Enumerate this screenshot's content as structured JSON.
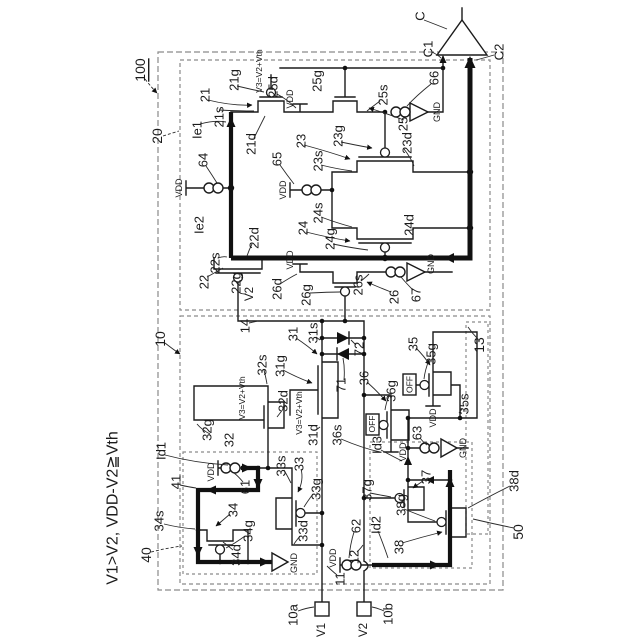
{
  "colors": {
    "ink": "#1b1b1b",
    "dashed_box": "#8a8a8a",
    "background": "#ffffff"
  },
  "figure_condition": "V1>V2, VDD-V2≧Vth",
  "labels": [
    {
      "n": "condition",
      "t": "V1>V2, VDD-V2≧Vth",
      "x": 113,
      "y": 508,
      "s": 16
    },
    {
      "n": "ref-100",
      "t": "100",
      "x": 140,
      "y": 70,
      "s": 14,
      "u": true
    },
    {
      "n": "ref-20",
      "t": "20",
      "x": 157,
      "y": 136,
      "s": 14
    },
    {
      "n": "ref-10",
      "t": "10",
      "x": 160,
      "y": 339,
      "s": 14
    },
    {
      "n": "ref-40",
      "t": "40",
      "x": 146,
      "y": 555,
      "s": 14
    },
    {
      "n": "ref-50",
      "t": "50",
      "x": 518,
      "y": 532,
      "s": 14
    },
    {
      "n": "ref-13",
      "t": "13",
      "x": 479,
      "y": 345,
      "s": 14
    },
    {
      "n": "ref-C",
      "t": "C",
      "x": 420,
      "y": 16,
      "s": 13
    },
    {
      "n": "ref-C1",
      "t": "C1",
      "x": 428,
      "y": 49,
      "s": 13
    },
    {
      "n": "ref-C2",
      "t": "C2",
      "x": 499,
      "y": 52,
      "s": 13
    },
    {
      "n": "ref-66",
      "t": "66",
      "x": 434,
      "y": 78,
      "s": 13
    },
    {
      "n": "gnd-66",
      "t": "GND",
      "x": 437,
      "y": 112,
      "s": 9
    },
    {
      "n": "ref-25",
      "t": "25",
      "x": 403,
      "y": 124,
      "s": 13
    },
    {
      "n": "ref-25s",
      "t": "25s",
      "x": 383,
      "y": 95,
      "s": 13
    },
    {
      "n": "ref-25g",
      "t": "25g",
      "x": 317,
      "y": 81,
      "s": 13
    },
    {
      "n": "ref-25d",
      "t": "25d",
      "x": 273,
      "y": 87,
      "s": 13
    },
    {
      "n": "vdd-25",
      "t": "VDD",
      "x": 290,
      "y": 99,
      "s": 9
    },
    {
      "n": "v3-21",
      "t": "V3=V2+Vth",
      "x": 259,
      "y": 71,
      "s": 8.5
    },
    {
      "n": "ref-21g",
      "t": "21g",
      "x": 234,
      "y": 80,
      "s": 13
    },
    {
      "n": "ref-21",
      "t": "21",
      "x": 205,
      "y": 95,
      "s": 13
    },
    {
      "n": "ref-21s",
      "t": "21s",
      "x": 219,
      "y": 117,
      "s": 13
    },
    {
      "n": "ref-Ie1",
      "t": "Ie1",
      "x": 197,
      "y": 130,
      "s": 13
    },
    {
      "n": "ref-21d",
      "t": "21d",
      "x": 251,
      "y": 144,
      "s": 13
    },
    {
      "n": "ref-64",
      "t": "64",
      "x": 203,
      "y": 160,
      "s": 13
    },
    {
      "n": "vdd-64",
      "t": "VDD",
      "x": 179,
      "y": 188,
      "s": 9
    },
    {
      "n": "ref-Ie2",
      "t": "Ie2",
      "x": 199,
      "y": 225,
      "s": 13
    },
    {
      "n": "ref-65",
      "t": "65",
      "x": 277,
      "y": 159,
      "s": 13
    },
    {
      "n": "vdd-65",
      "t": "VDD",
      "x": 283,
      "y": 190,
      "s": 9
    },
    {
      "n": "ref-23",
      "t": "23",
      "x": 301,
      "y": 141,
      "s": 13
    },
    {
      "n": "ref-23s",
      "t": "23s",
      "x": 318,
      "y": 161,
      "s": 13
    },
    {
      "n": "ref-23g",
      "t": "23g",
      "x": 338,
      "y": 136,
      "s": 13
    },
    {
      "n": "ref-23d",
      "t": "23d",
      "x": 407,
      "y": 143,
      "s": 13
    },
    {
      "n": "ref-24s",
      "t": "24s",
      "x": 318,
      "y": 213,
      "s": 13
    },
    {
      "n": "ref-24",
      "t": "24",
      "x": 303,
      "y": 228,
      "s": 13
    },
    {
      "n": "ref-24g",
      "t": "24g",
      "x": 330,
      "y": 239,
      "s": 13
    },
    {
      "n": "ref-24d",
      "t": "24d",
      "x": 409,
      "y": 225,
      "s": 13
    },
    {
      "n": "ref-22d",
      "t": "22d",
      "x": 254,
      "y": 238,
      "s": 13
    },
    {
      "n": "ref-22s",
      "t": "22s",
      "x": 215,
      "y": 263,
      "s": 13
    },
    {
      "n": "ref-22",
      "t": "22",
      "x": 204,
      "y": 282,
      "s": 13
    },
    {
      "n": "ref-22g",
      "t": "22g",
      "x": 236,
      "y": 283,
      "s": 13
    },
    {
      "n": "net-V2",
      "t": "V2",
      "x": 250,
      "y": 294,
      "s": 11.5
    },
    {
      "n": "ref-26d",
      "t": "26d",
      "x": 277,
      "y": 289,
      "s": 13
    },
    {
      "n": "vdd-26",
      "t": "VDD",
      "x": 290,
      "y": 260,
      "s": 9
    },
    {
      "n": "ref-26g",
      "t": "26g",
      "x": 306,
      "y": 295,
      "s": 13
    },
    {
      "n": "ref-26s",
      "t": "26s",
      "x": 358,
      "y": 285,
      "s": 13
    },
    {
      "n": "ref-26",
      "t": "26",
      "x": 394,
      "y": 297,
      "s": 13
    },
    {
      "n": "ref-67",
      "t": "67",
      "x": 416,
      "y": 295,
      "s": 13
    },
    {
      "n": "gnd-67",
      "t": "GND",
      "x": 431,
      "y": 264,
      "s": 9
    },
    {
      "n": "ref-14",
      "t": "14",
      "x": 245,
      "y": 326,
      "s": 13
    },
    {
      "n": "ref-31",
      "t": "31",
      "x": 293,
      "y": 334,
      "s": 13
    },
    {
      "n": "ref-31s",
      "t": "31s",
      "x": 313,
      "y": 333,
      "s": 13
    },
    {
      "n": "ref-31g",
      "t": "31g",
      "x": 280,
      "y": 366,
      "s": 13
    },
    {
      "n": "ref-32s",
      "t": "32s",
      "x": 262,
      "y": 365,
      "s": 13
    },
    {
      "n": "v3-32",
      "t": "V3=V2+Vth",
      "x": 242,
      "y": 398,
      "s": 8.5
    },
    {
      "n": "ref-32d",
      "t": "32d",
      "x": 283,
      "y": 401,
      "s": 13
    },
    {
      "n": "ref-32g",
      "t": "32g",
      "x": 207,
      "y": 430,
      "s": 13
    },
    {
      "n": "ref-32",
      "t": "32",
      "x": 229,
      "y": 440,
      "s": 13
    },
    {
      "n": "v3-31",
      "t": "V3=V2+Vth",
      "x": 299,
      "y": 413,
      "s": 8.5
    },
    {
      "n": "ref-31d",
      "t": "31d",
      "x": 313,
      "y": 435,
      "s": 13
    },
    {
      "n": "ref-71",
      "t": "71",
      "x": 341,
      "y": 385,
      "s": 13
    },
    {
      "n": "ref-72",
      "t": "72",
      "x": 359,
      "y": 349,
      "s": 13
    },
    {
      "n": "ref-36",
      "t": "36",
      "x": 364,
      "y": 378,
      "s": 13
    },
    {
      "n": "ref-36g",
      "t": "36g",
      "x": 391,
      "y": 391,
      "s": 13
    },
    {
      "n": "state-off-36",
      "t": "OFF",
      "x": 372,
      "y": 424,
      "s": 8.5
    },
    {
      "n": "vdd-36",
      "t": "VDD",
      "x": 403,
      "y": 452,
      "s": 9
    },
    {
      "n": "ref-36s",
      "t": "36s",
      "x": 337,
      "y": 435,
      "s": 13
    },
    {
      "n": "ref-35",
      "t": "35",
      "x": 413,
      "y": 344,
      "s": 13
    },
    {
      "n": "ref-35g",
      "t": "35g",
      "x": 431,
      "y": 354,
      "s": 13
    },
    {
      "n": "state-off-35",
      "t": "OFF",
      "x": 409.5,
      "y": 384.5,
      "s": 8.5
    },
    {
      "n": "vdd-35",
      "t": "VDD",
      "x": 433,
      "y": 418,
      "s": 9
    },
    {
      "n": "ref-35s",
      "t": "35s",
      "x": 464,
      "y": 404,
      "s": 13
    },
    {
      "n": "ref-63",
      "t": "63",
      "x": 417,
      "y": 433,
      "s": 13
    },
    {
      "n": "gnd-63",
      "t": "GND",
      "x": 463,
      "y": 448,
      "s": 9
    },
    {
      "n": "ref-Id3",
      "t": "Id3",
      "x": 377,
      "y": 445,
      "s": 13
    },
    {
      "n": "ref-37g",
      "t": "37g",
      "x": 367,
      "y": 490,
      "s": 13
    },
    {
      "n": "ref-37",
      "t": "37",
      "x": 426,
      "y": 477,
      "s": 13
    },
    {
      "n": "ref-38g",
      "t": "38g",
      "x": 401,
      "y": 505,
      "s": 13
    },
    {
      "n": "ref-38",
      "t": "38",
      "x": 399,
      "y": 547,
      "s": 13
    },
    {
      "n": "ref-62",
      "t": "62",
      "x": 356,
      "y": 526,
      "s": 13
    },
    {
      "n": "ref-Id2",
      "t": "Id2",
      "x": 376,
      "y": 525,
      "s": 13
    },
    {
      "n": "vdd-62",
      "t": "VDD",
      "x": 333,
      "y": 558,
      "s": 9
    },
    {
      "n": "ref-38d",
      "t": "38d",
      "x": 514,
      "y": 481,
      "s": 13
    },
    {
      "n": "ref-Id1",
      "t": "Id1",
      "x": 161,
      "y": 451,
      "s": 13
    },
    {
      "n": "ref-41",
      "t": "41",
      "x": 176,
      "y": 482,
      "s": 13
    },
    {
      "n": "vdd-61",
      "t": "VDD",
      "x": 211,
      "y": 472,
      "s": 9
    },
    {
      "n": "ref-61",
      "t": "61",
      "x": 245,
      "y": 487,
      "s": 13
    },
    {
      "n": "ref-33s",
      "t": "33s",
      "x": 281,
      "y": 466,
      "s": 13
    },
    {
      "n": "ref-33",
      "t": "33",
      "x": 299,
      "y": 464,
      "s": 13
    },
    {
      "n": "ref-33g",
      "t": "33g",
      "x": 316,
      "y": 489,
      "s": 13
    },
    {
      "n": "ref-34",
      "t": "34",
      "x": 233,
      "y": 510,
      "s": 13
    },
    {
      "n": "ref-34g",
      "t": "34g",
      "x": 248,
      "y": 531,
      "s": 13
    },
    {
      "n": "ref-34s",
      "t": "34s",
      "x": 159,
      "y": 521,
      "s": 13
    },
    {
      "n": "ref-34d",
      "t": "34d",
      "x": 236,
      "y": 555,
      "s": 13
    },
    {
      "n": "ref-33d",
      "t": "33d",
      "x": 303,
      "y": 531,
      "s": 13
    },
    {
      "n": "gnd-40",
      "t": "GND",
      "x": 294,
      "y": 563,
      "s": 9
    },
    {
      "n": "ref-11",
      "t": "11",
      "x": 340,
      "y": 579,
      "s": 13
    },
    {
      "n": "ref-12",
      "t": "12",
      "x": 354,
      "y": 557,
      "s": 13
    },
    {
      "n": "ref-10a",
      "t": "10a",
      "x": 293,
      "y": 615,
      "s": 13
    },
    {
      "n": "term-V1",
      "t": "V1",
      "x": 322,
      "y": 630,
      "s": 11.5
    },
    {
      "n": "ref-10b",
      "t": "10b",
      "x": 388,
      "y": 614,
      "s": 13
    },
    {
      "n": "term-V2",
      "t": "V2",
      "x": 364,
      "y": 630,
      "s": 11.5
    }
  ]
}
